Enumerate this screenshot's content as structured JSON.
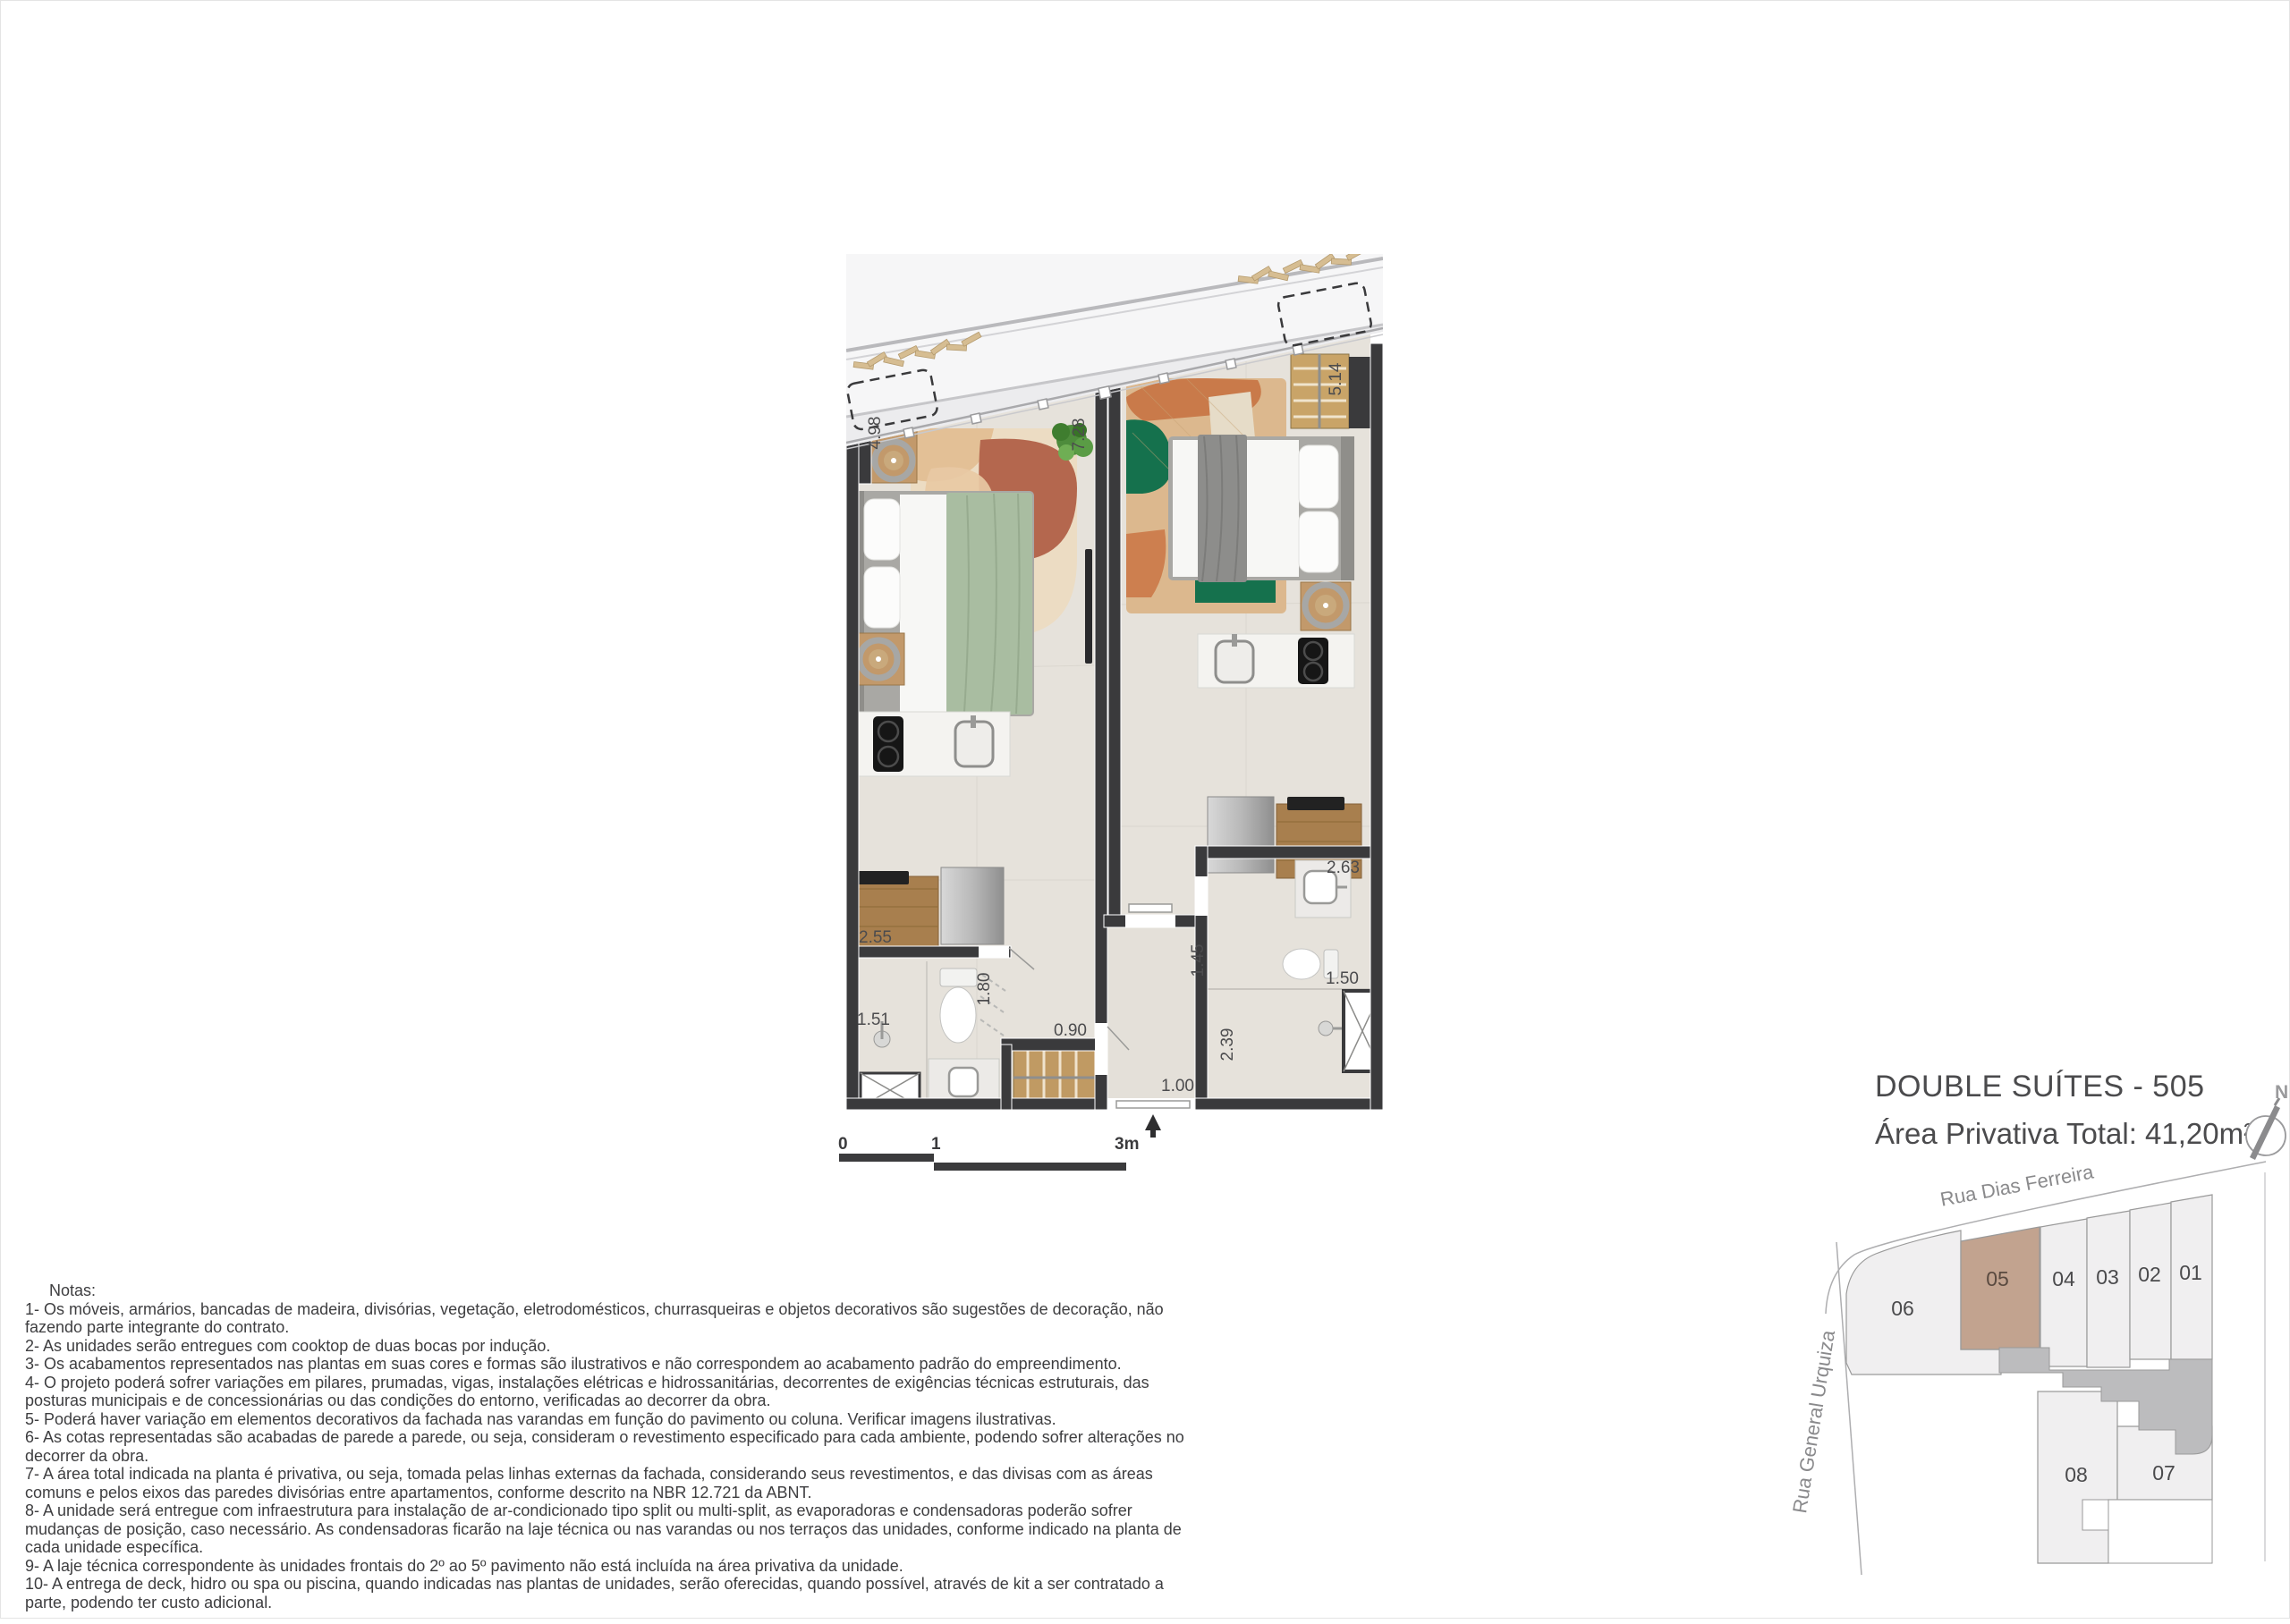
{
  "header": {
    "title": "DOUBLE SUÍTES - 505",
    "subtitle": "Área Privativa Total: 41,20m²"
  },
  "compass": {
    "north_label": "N"
  },
  "scale_bar": {
    "tick0": "0",
    "tick1": "1",
    "tick2": "3m"
  },
  "floor_plan": {
    "dims": {
      "d498": "4.98",
      "d728": "7.28",
      "d514": "5.14",
      "d255": "2.55",
      "d263": "2.63",
      "d151": "1.51",
      "d180": "1.80",
      "d145": "1.45",
      "d150": "1.50",
      "d239": "2.39",
      "d090": "0.90",
      "d100": "1.00"
    },
    "colors": {
      "wall": "#3a3a3c",
      "floor": "#e6e2db",
      "wood": "#c2996b",
      "blanket_green": "#a9bda1",
      "rug_green": "#15714d"
    }
  },
  "site_map": {
    "street_top": "Rua Dias Ferreira",
    "street_left": "Rua General Urquiza",
    "highlighted_unit": "05",
    "units": {
      "u01": "01",
      "u02": "02",
      "u03": "03",
      "u04": "04",
      "u05": "05",
      "u06": "06",
      "u07": "07",
      "u08": "08"
    },
    "colors": {
      "highlight": "#c2a38f",
      "lot": "#f0eff0",
      "common": "#bcbcbe"
    }
  },
  "notes": {
    "heading": "Notas:",
    "items": [
      "1- Os móveis, armários, bancadas de madeira, divisórias, vegetação, eletrodomésticos, churrasqueiras e objetos decorativos são sugestões de decoração, não fazendo parte integrante do contrato.",
      "2- As unidades serão entregues com cooktop de duas bocas por indução.",
      "3- Os acabamentos  representados nas plantas em suas cores e formas são ilustrativos e não  correspondem ao acabamento padrão do  empreendimento.",
      "4- O projeto poderá sofrer variações em pilares,  prumadas,  vigas,  instalações elétricas e hidrossanitárias,  decorrentes de exigências técnicas estruturais, das posturas municipais e de concessionárias ou das condições do entorno, verificadas ao decorrer da obra.",
      "5- Poderá haver variação em elementos decorativos da fachada nas varandas em função do pavimento ou coluna. Verificar imagens ilustrativas.",
      "6- As  cotas  representadas  são  acabadas  de parede a  parede, ou seja,  consideram o revestimento  especificado para cada  ambiente,  podendo  sofrer alterações no decorrer da obra.",
      "7- A área  total indicada  na planta é privativa, ou seja,  tomada pelas linhas externas da fachada,  considerando seus revestimentos, e das divisas  com as áreas comuns e pelos eixos das paredes divisórias entre apartamentos, conforme descrito na NBR 12.721 da ABNT.",
      "8- A unidade será entregue com infraestrutura para instalação de ar-condicionado tipo split ou multi-split, as evaporadoras e condensadoras poderão sofrer mudanças  de posição, caso necessário.  As condensadoras ficarão na laje técnica ou  nas varandas ou nos terraços das unidades,  conforme indicado na planta de cada unidade específica.",
      "9- A laje técnica correspondente às unidades frontais do 2º ao 5º pavimento não está incluída na área privativa da unidade.",
      "10- A entrega  de  deck,  hidro ou spa ou piscina,  quando  indicadas  nas plantas de unidades,  serão  oferecidas,  quando  possível,  através  de kit a  ser contratado a parte, podendo ter custo adicional."
    ]
  }
}
